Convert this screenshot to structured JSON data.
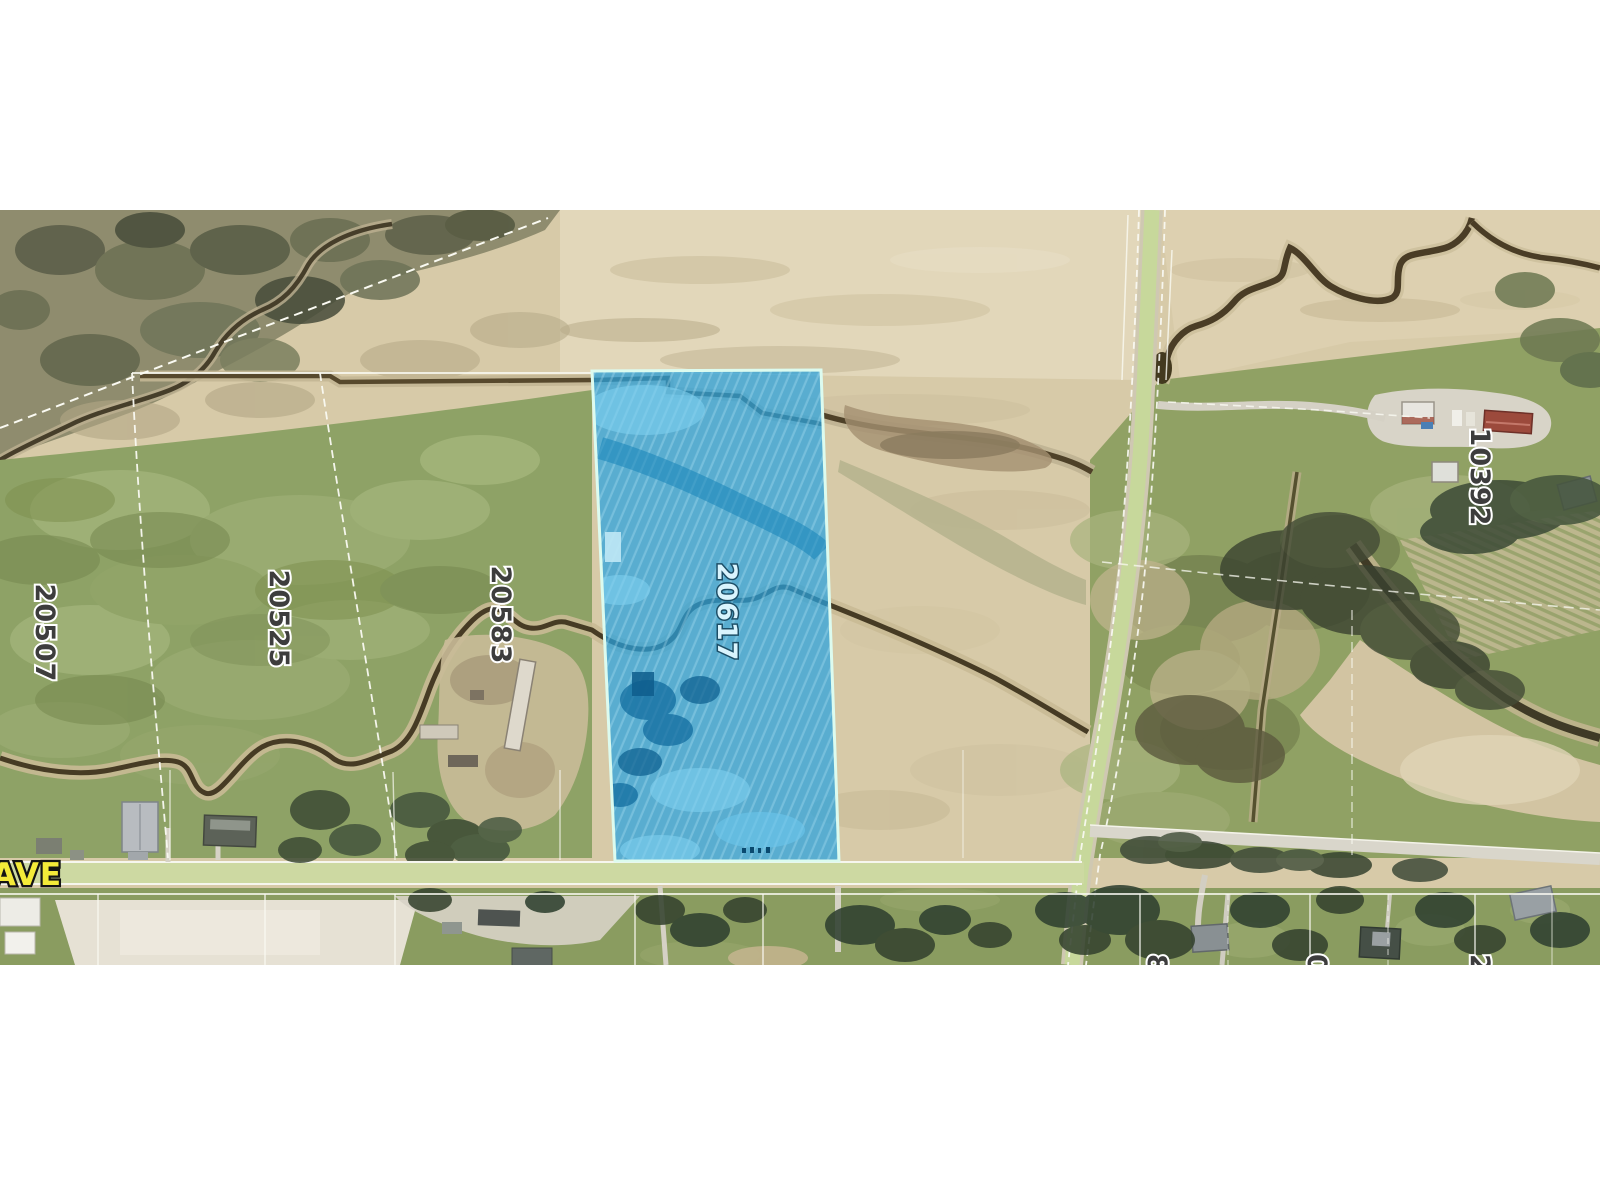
{
  "title": "Aerial parcel map with highlighted lot",
  "map": {
    "highlight_color": "#2fa8e0",
    "highlight_border": "#dcfbef",
    "label_color": "#3d3d3d",
    "road_label_color": "#f3ea39",
    "parcel_labels": [
      {
        "text": "20507"
      },
      {
        "text": "20525"
      },
      {
        "text": "20583"
      },
      {
        "text": "20617"
      },
      {
        "text": "10392"
      }
    ],
    "highlighted_parcel": {
      "number": "20617"
    },
    "road_label": {
      "text": "AVE"
    },
    "partial_labels": [
      {
        "text": "8"
      },
      {
        "text": "0"
      },
      {
        "text": "2"
      }
    ]
  }
}
